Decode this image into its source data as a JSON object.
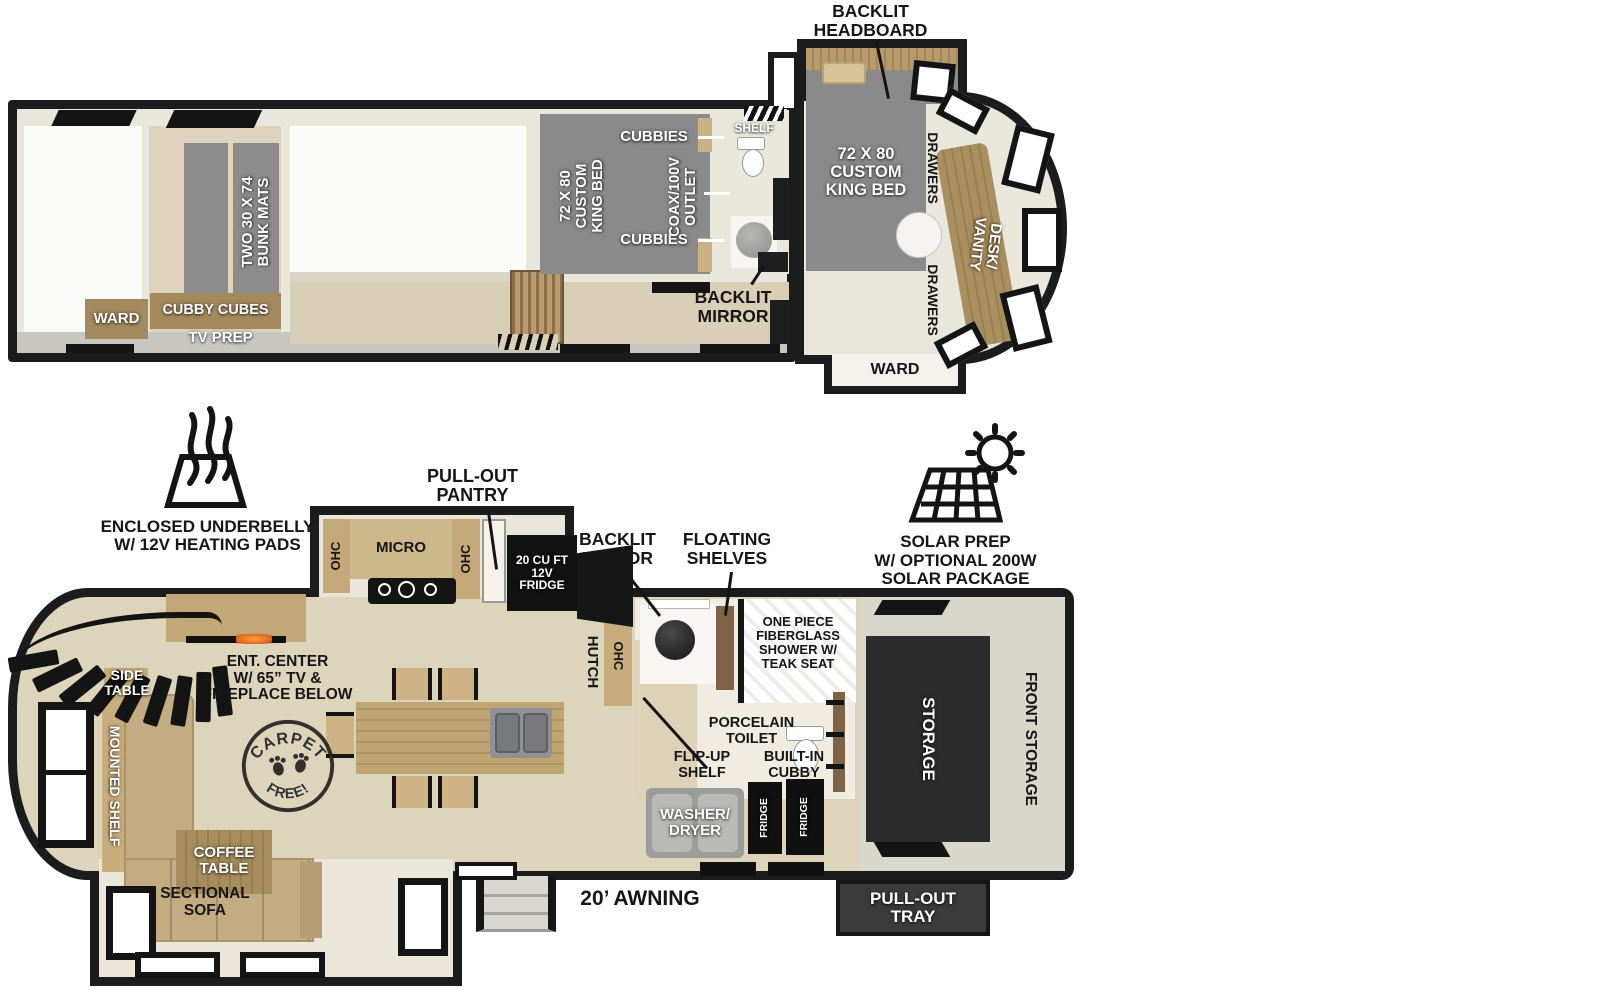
{
  "colors": {
    "wall": "#1c1c1c",
    "floor_beige": "#e9e5d8",
    "floor_wood": "#ddd3bb",
    "cabinet_wood": "#c4a878",
    "bed_gray": "#8a8a8a",
    "appliance_black": "#121212",
    "storage_dark": "#2c2c2c",
    "sofa_tan": "#c3ab82",
    "fireplace_flame": "#f7a23b"
  },
  "upper": {
    "headboard_callout": "BACKLIT\nHEADBOARD",
    "bunk_mats": "TWO 30 X 74\nBUNK MATS",
    "ward_rear": "WARD",
    "cubby_cubes": "CUBBY CUBES",
    "tv_prep": "TV PREP",
    "cubbies_top": "CUBBIES",
    "cubbies_bottom": "CUBBIES",
    "coax_outlet": "COAX/100V\nOUTLET",
    "king_bed_mid": "72 X 80\nCUSTOM\nKING BED",
    "shelf": "SHELF",
    "backlit_mirror": "BACKLIT\nMIRROR",
    "king_bed_front": "72 X 80\nCUSTOM\nKING BED",
    "drawers_top": "DRAWERS",
    "drawers_bottom": "DRAWERS",
    "desk_vanity": "DESK/\nVANITY",
    "ward_front": "WARD"
  },
  "lower": {
    "underbelly_callout": "ENCLOSED UNDERBELLY\nW/ 12V HEATING PADS",
    "pantry_callout": "PULL-OUT\nPANTRY",
    "mirror_callout": "BACKLIT\nMIRROR",
    "shelves_callout": "FLOATING\nSHELVES",
    "solar_callout": "SOLAR PREP\nW/ OPTIONAL 200W\nSOLAR PACKAGE",
    "ohc_left": "OHC",
    "micro": "MICRO",
    "ohc_right": "OHC",
    "fridge_main": "20 CU FT\n12V\nFRIDGE",
    "hutch": "HUTCH",
    "ohc_hutch": "OHC",
    "ent_center": "ENT. CENTER\nW/ 65” TV &\nFIREPLACE BELOW",
    "side_table": "SIDE\nTABLE",
    "mounted_shelf": "MOUNTED SHELF",
    "coffee_table": "COFFEE\nTABLE",
    "sectional_sofa": "SECTIONAL\nSOFA",
    "carpet_top": "CARPET",
    "carpet_bottom": "FREE!",
    "shower": "ONE PIECE\nFIBERGLASS\nSHOWER W/\nTEAK SEAT",
    "toilet": "PORCELAIN\nTOILET",
    "flip_up_shelf": "FLIP-UP\nSHELF",
    "built_in_cubby": "BUILT-IN\nCUBBY",
    "washer_dryer": "WASHER/\nDRYER",
    "fridge_a": "FRIDGE",
    "fridge_b": "FRIDGE",
    "storage": "STORAGE",
    "front_storage": "FRONT STORAGE",
    "pull_out_tray": "PULL-OUT\nTRAY",
    "awning": "20’ AWNING"
  }
}
